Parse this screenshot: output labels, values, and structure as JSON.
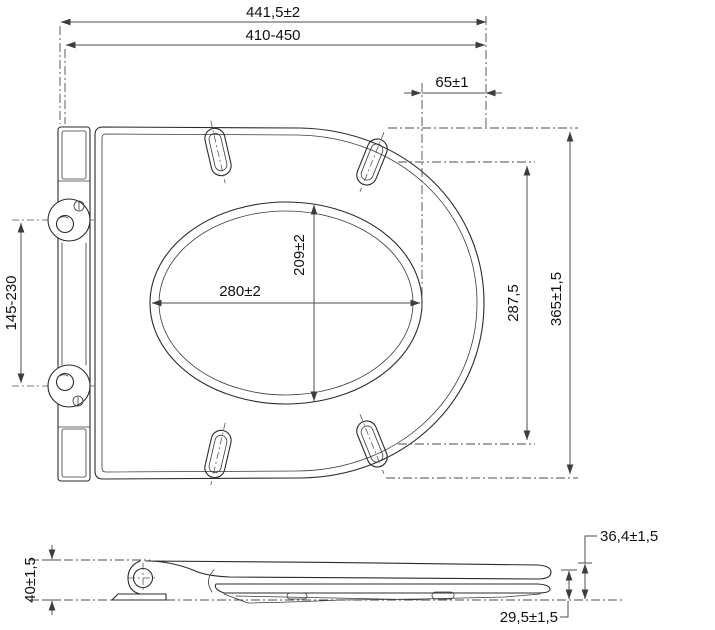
{
  "dimensions": {
    "overall_length": "441,5±2",
    "adjustable_length": "410-450",
    "front_rim": "65±1",
    "hinge_centers": "145-230",
    "opening_width": "280±2",
    "opening_depth": "209±2",
    "bumper_span": "287,5",
    "overall_width": "365±1,5",
    "back_height": "40±1,5",
    "total_height": "36,4±1,5",
    "seat_height": "29,5±1,5"
  }
}
